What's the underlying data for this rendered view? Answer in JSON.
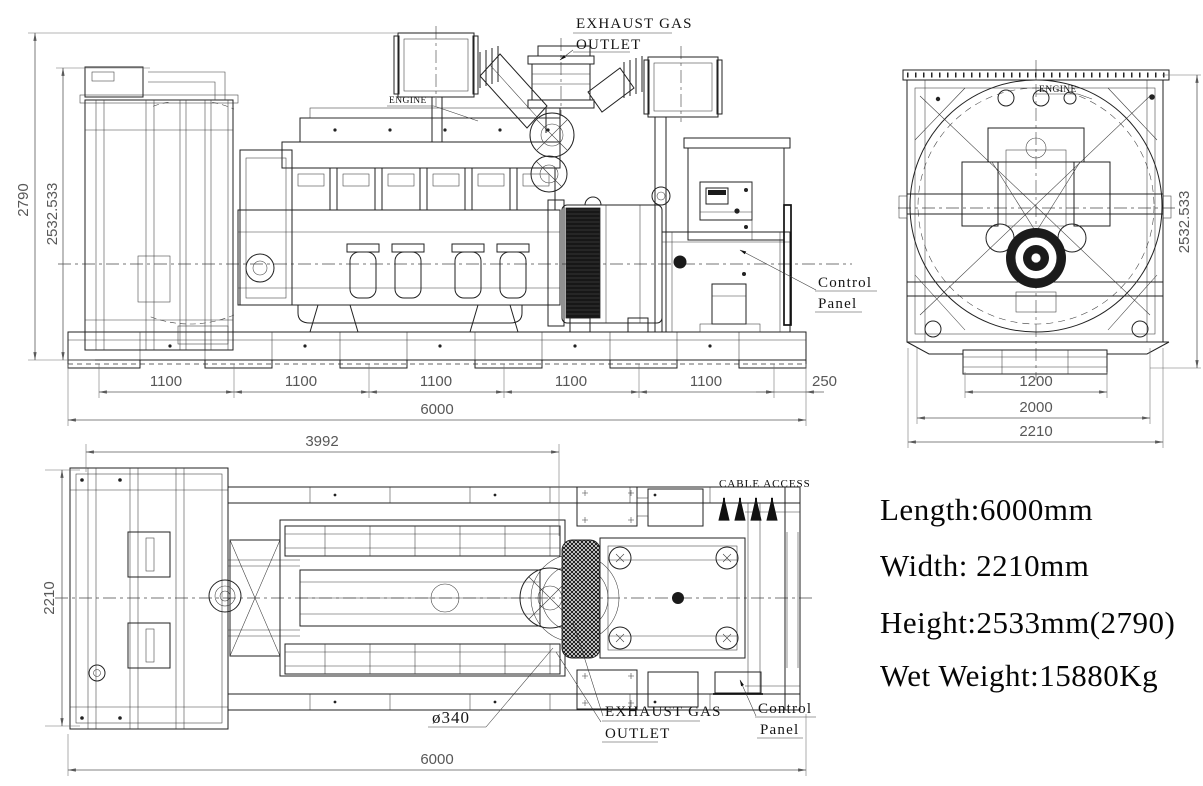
{
  "drawing_title": "Generator set general arrangement drawing",
  "side_view": {
    "exhaust_label_line1": "EXHAUST GAS",
    "exhaust_label_line2": "OUTLET",
    "engine_label": "ENGINE",
    "control_panel_label_line1": "Control",
    "control_panel_label_line2": "Panel",
    "dim_height_overall": "2790",
    "dim_height_frame": "2532.533",
    "dim_segments": [
      "1100",
      "1100",
      "1100",
      "1100",
      "1100"
    ],
    "dim_end_offset": "250",
    "dim_total_length": "6000"
  },
  "end_view": {
    "engine_label": "ENGINE",
    "dim_height_frame": "2532.533",
    "dim_base_inner": "1200",
    "dim_base_mid": "2000",
    "dim_overall_width": "2210"
  },
  "top_view": {
    "dim_front_length": "3992",
    "dim_overall_width": "2210",
    "dim_total_length": "6000",
    "cable_access_label": "CABLE ACCESS",
    "exhaust_label_line1": "EXHAUST GAS",
    "exhaust_label_line2": "OUTLET",
    "exhaust_diameter": "ø340",
    "control_panel_label_line1": "Control",
    "control_panel_label_line2": "Panel"
  },
  "specs": {
    "length": "Length:6000mm",
    "width": "Width: 2210mm",
    "height": "Height:2533mm(2790)",
    "wet_weight": "Wet Weight:15880Kg"
  },
  "colors": {
    "line": "#222222",
    "dimension": "#5a5a5a",
    "background": "#ffffff"
  }
}
